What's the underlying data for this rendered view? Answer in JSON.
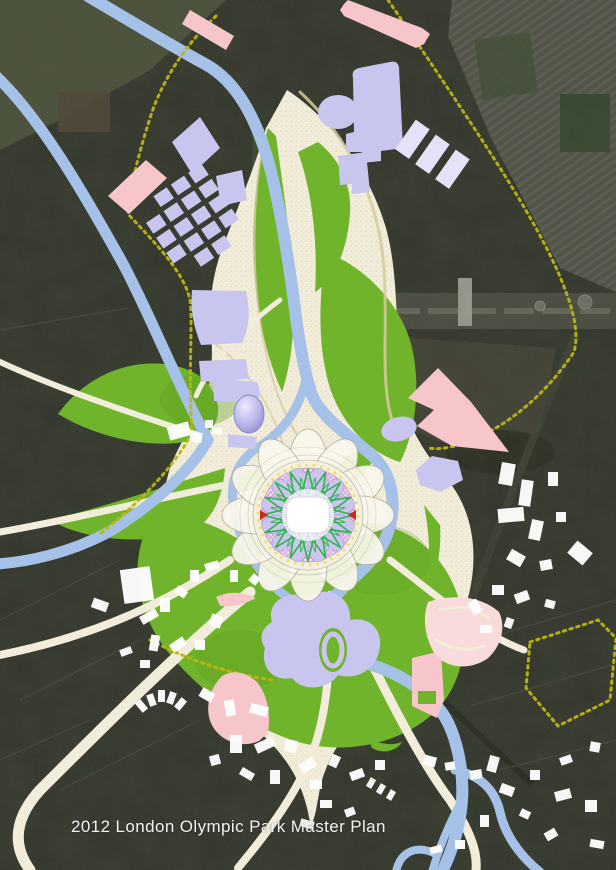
{
  "caption": "2012 London Olympic Park Master Plan",
  "colors": {
    "satellite_dark": "#2d3027",
    "satellite_field": "#49513a",
    "park_green": "#6fb42a",
    "park_green_dark": "#5f9c1f",
    "path_cream": "#f2edda",
    "path_speckle": "#d5ca9f",
    "building_lavender": "#c8c6ee",
    "building_pale_lavender": "#e4e2f8",
    "venue_pink": "#f7c6cb",
    "venue_pale_pink": "#f9dbdc",
    "existing_white": "#fdfdfd",
    "river_blue": "#a6c2e7",
    "river_sparkle": "#eaf2fb",
    "boundary_yellow": "#bdb512",
    "stadium_ring_pink": "#eed7ef",
    "stadium_hatch_pink": "#d49fd6",
    "stadium_star_green": "#2eb44d",
    "stadium_accent_yellow": "#e6e35e",
    "stadium_accent_red": "#c62b20",
    "stadium_petal_white": "#faf7ed",
    "caption_color": "#f2f2f2"
  }
}
